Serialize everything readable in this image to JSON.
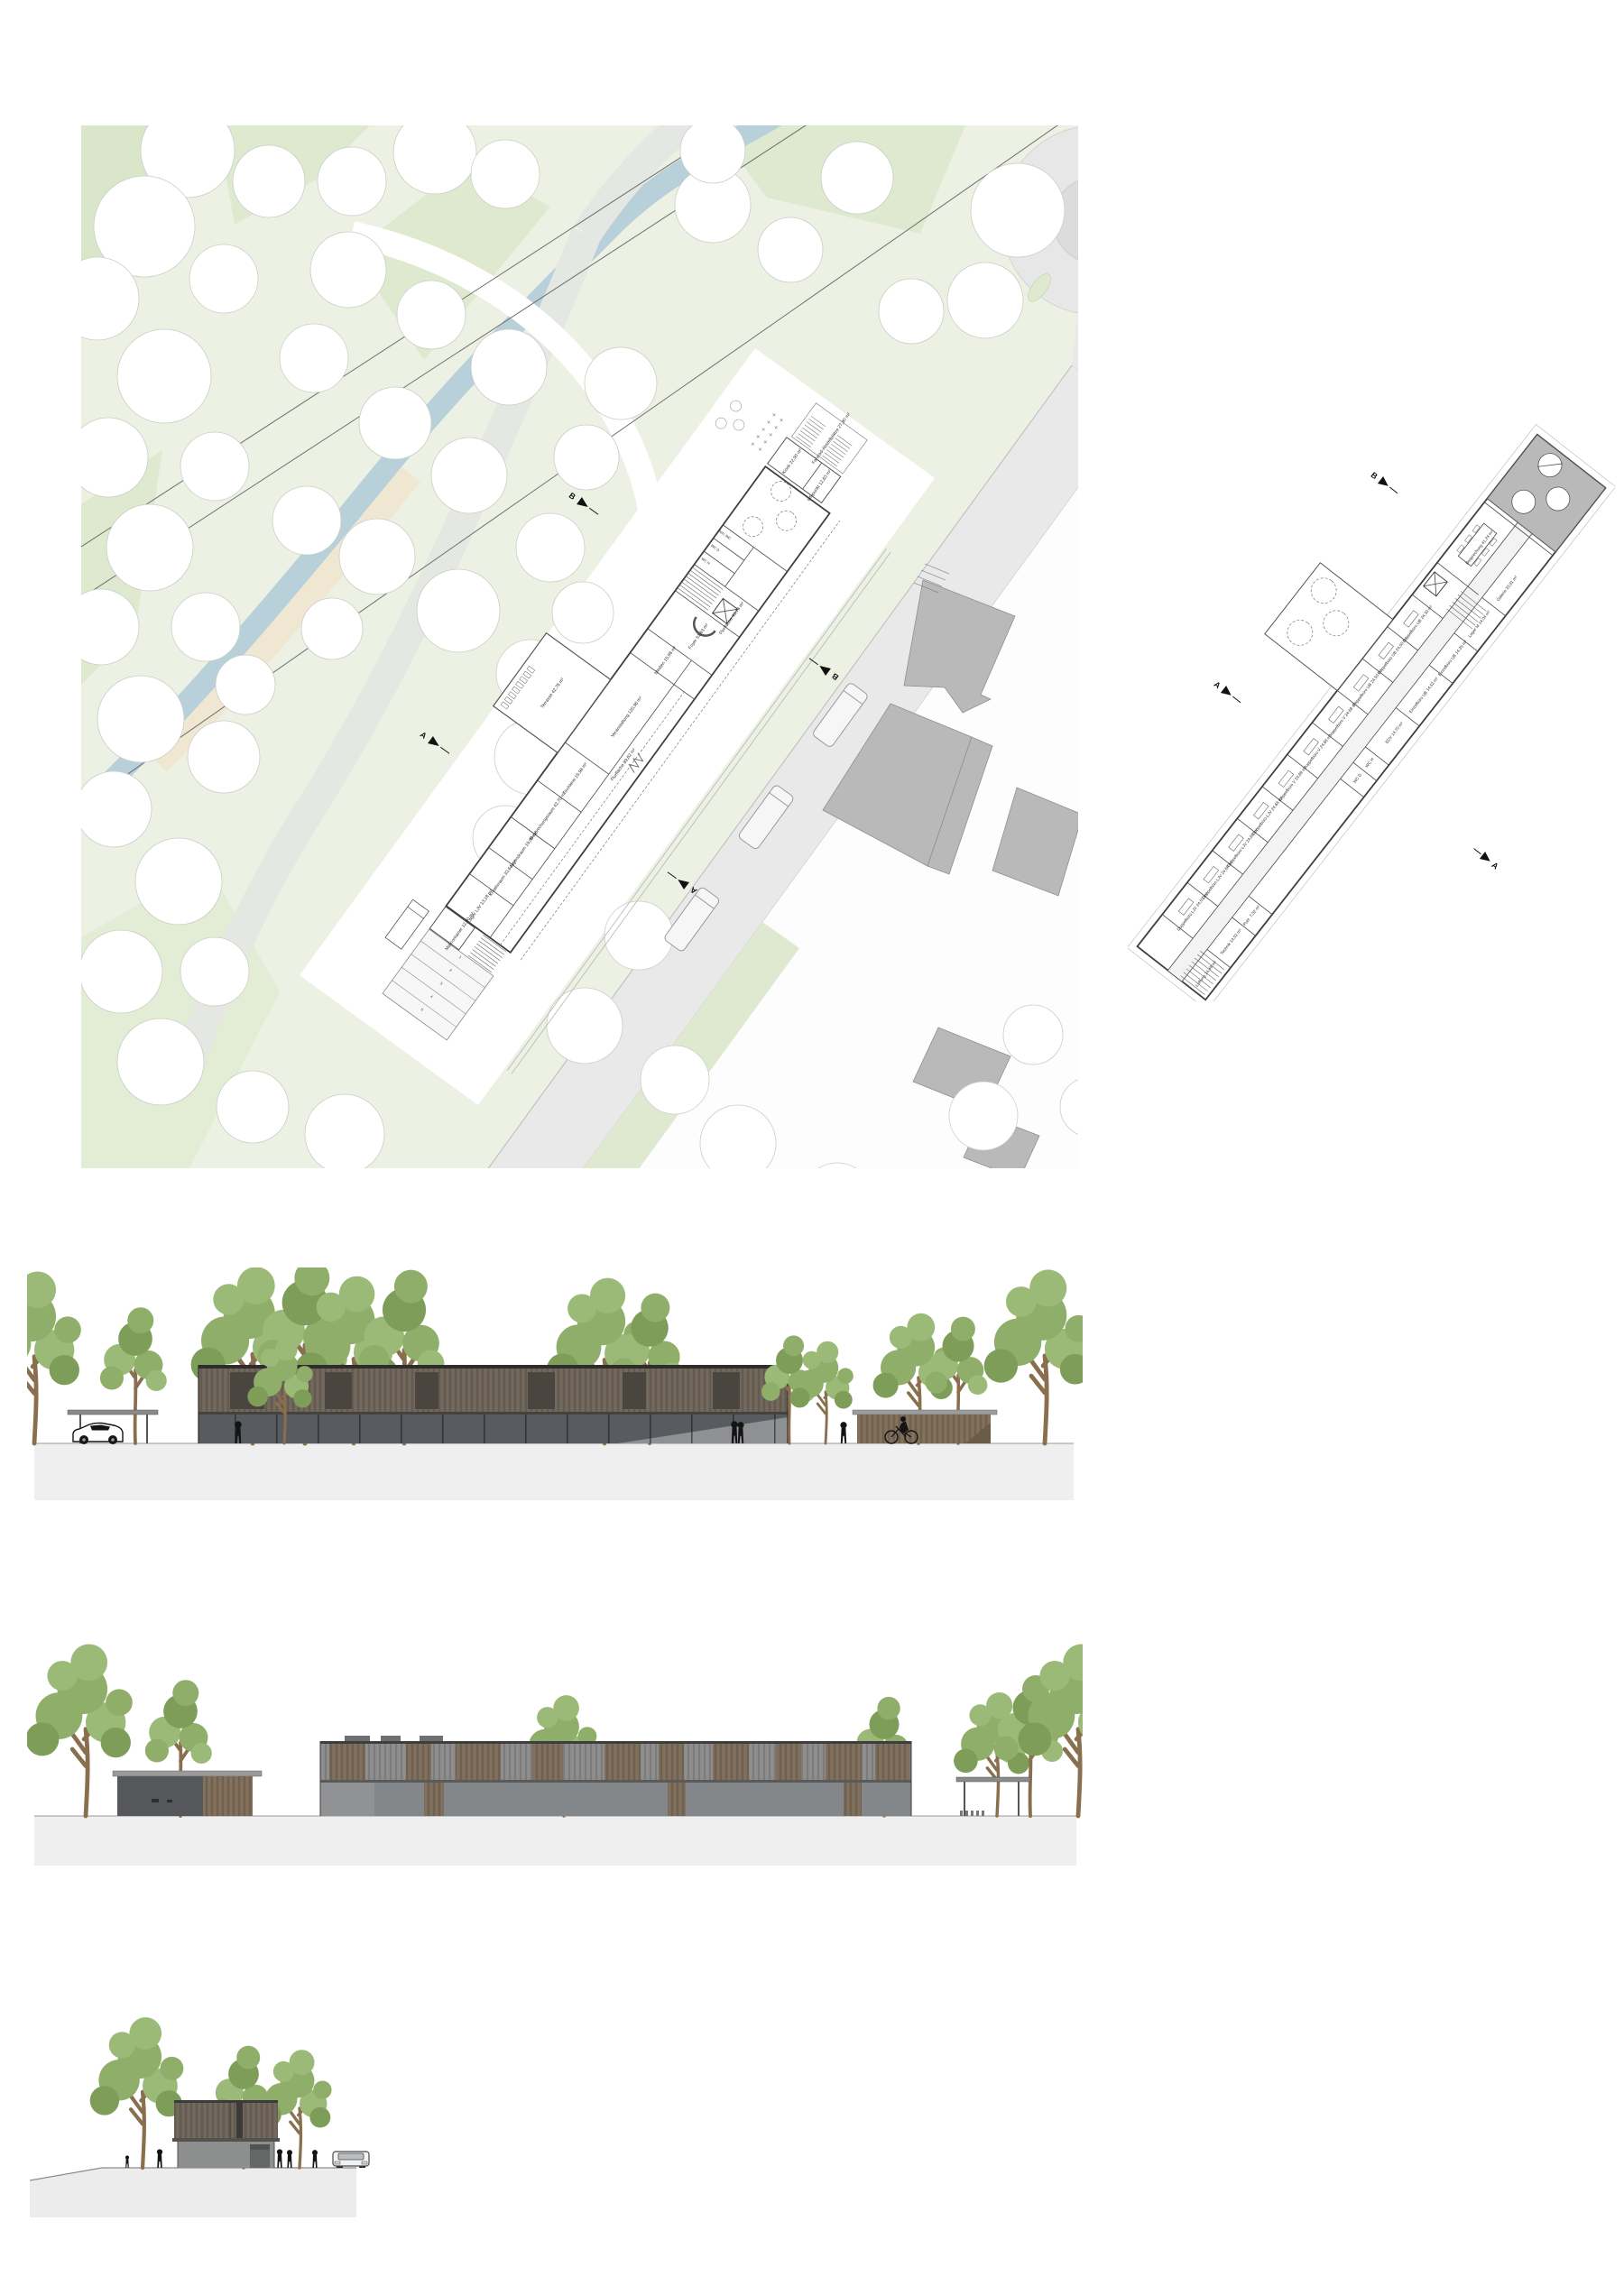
{
  "colors": {
    "park": "#ecf1e4",
    "park_dark": "#d6e3c2",
    "park_mid": "#dfe9cf",
    "stream": "#b7d0d9",
    "sand": "#f0e7d3",
    "path": "#e4e7e2",
    "road": "#e9e9ea",
    "neighbor_gray": "#b9b9ba",
    "plan_ink": "#3f3f3f",
    "wood": "#6e6459",
    "wood_dark": "#4b4540",
    "glass": "#585b5f",
    "glass_light": "#84878a",
    "annex_wood": "#7d6c57",
    "annex_dark": "#55575a",
    "upper_gray": "#8b8b8b",
    "slat_brown": "#7b6c5a",
    "ground_band": "#efefef",
    "silhouette": "#141414",
    "tree_green": "#8fae69",
    "tree_green2": "#9cba77",
    "tree_green3": "#7d9d58",
    "trunk": "#8a6f4f"
  },
  "site_plan": {
    "markers": {
      "a": "A",
      "b": "B"
    },
    "parking_numbers": [
      "5",
      "4",
      "3",
      "2",
      "1"
    ],
    "rooms": [
      {
        "text": "Müllcontainer 12,00 m²"
      },
      {
        "text": "Lager LJV 13,18 m²"
      },
      {
        "text": "Kreativraum 33,64 m²"
      },
      {
        "text": "Jugendraum 19,86 m²"
      },
      {
        "text": "Besprechungsraum 42,70 m²"
      },
      {
        "text": "Tischlerei 15,98 m²"
      },
      {
        "text": "Veranstaltung 120,96 m²"
      },
      {
        "text": "Terrasse 42,76 m²"
      },
      {
        "text": "Medien 15,98 m²"
      },
      {
        "text": "Foyer 51,63 m²"
      },
      {
        "text": "Flurfläche 89,62 m²"
      },
      {
        "text": "Flurfläche 43,78 m²"
      },
      {
        "text": "WC H"
      },
      {
        "text": "WC D"
      },
      {
        "text": "Beh.-WC"
      },
      {
        "text": "Kiosk 22,90 m²"
      },
      {
        "text": "Infopunkt 12,63 m²"
      },
      {
        "text": "Fahrrad-Abstellplätze 27,90 m²"
      }
    ]
  },
  "floor_plan": {
    "markers": {
      "a": "A",
      "b": "B"
    },
    "rooms": [
      {
        "text": "Doppelbüro LJV 24,53 m²"
      },
      {
        "text": "Doppelbüro LJV 24,68 m²"
      },
      {
        "text": "Doppelbüro LJV 24,68 m²"
      },
      {
        "text": "Doppelbüro LJV 24,68 m²"
      },
      {
        "text": "Doppelbüro V 24,68 m²"
      },
      {
        "text": "Doppelbüro V 24,68 m²"
      },
      {
        "text": "Doppelbüro V 24,68 m²"
      },
      {
        "text": "Doppelbüro UB 24,50 m²"
      },
      {
        "text": "Doppelbüro UB 24,50 m²"
      },
      {
        "text": "Doppelbüro UB 24,30 m²"
      },
      {
        "text": "Lüftung 14,48 m²"
      },
      {
        "text": "Technik 14,52 m²"
      },
      {
        "text": "Putz. 7,02 m²"
      },
      {
        "text": "WC D"
      },
      {
        "text": "WC H"
      },
      {
        "text": "EDV 14,70 m²"
      },
      {
        "text": "Einzelbüro UB 14,52 m²"
      },
      {
        "text": "Einzelbüro UB 14,35 m²"
      },
      {
        "text": "Lager M 14,04 m²"
      },
      {
        "text": "Besprechung 41,24 m²"
      },
      {
        "text": "Galerie 33,91 m²"
      }
    ]
  }
}
